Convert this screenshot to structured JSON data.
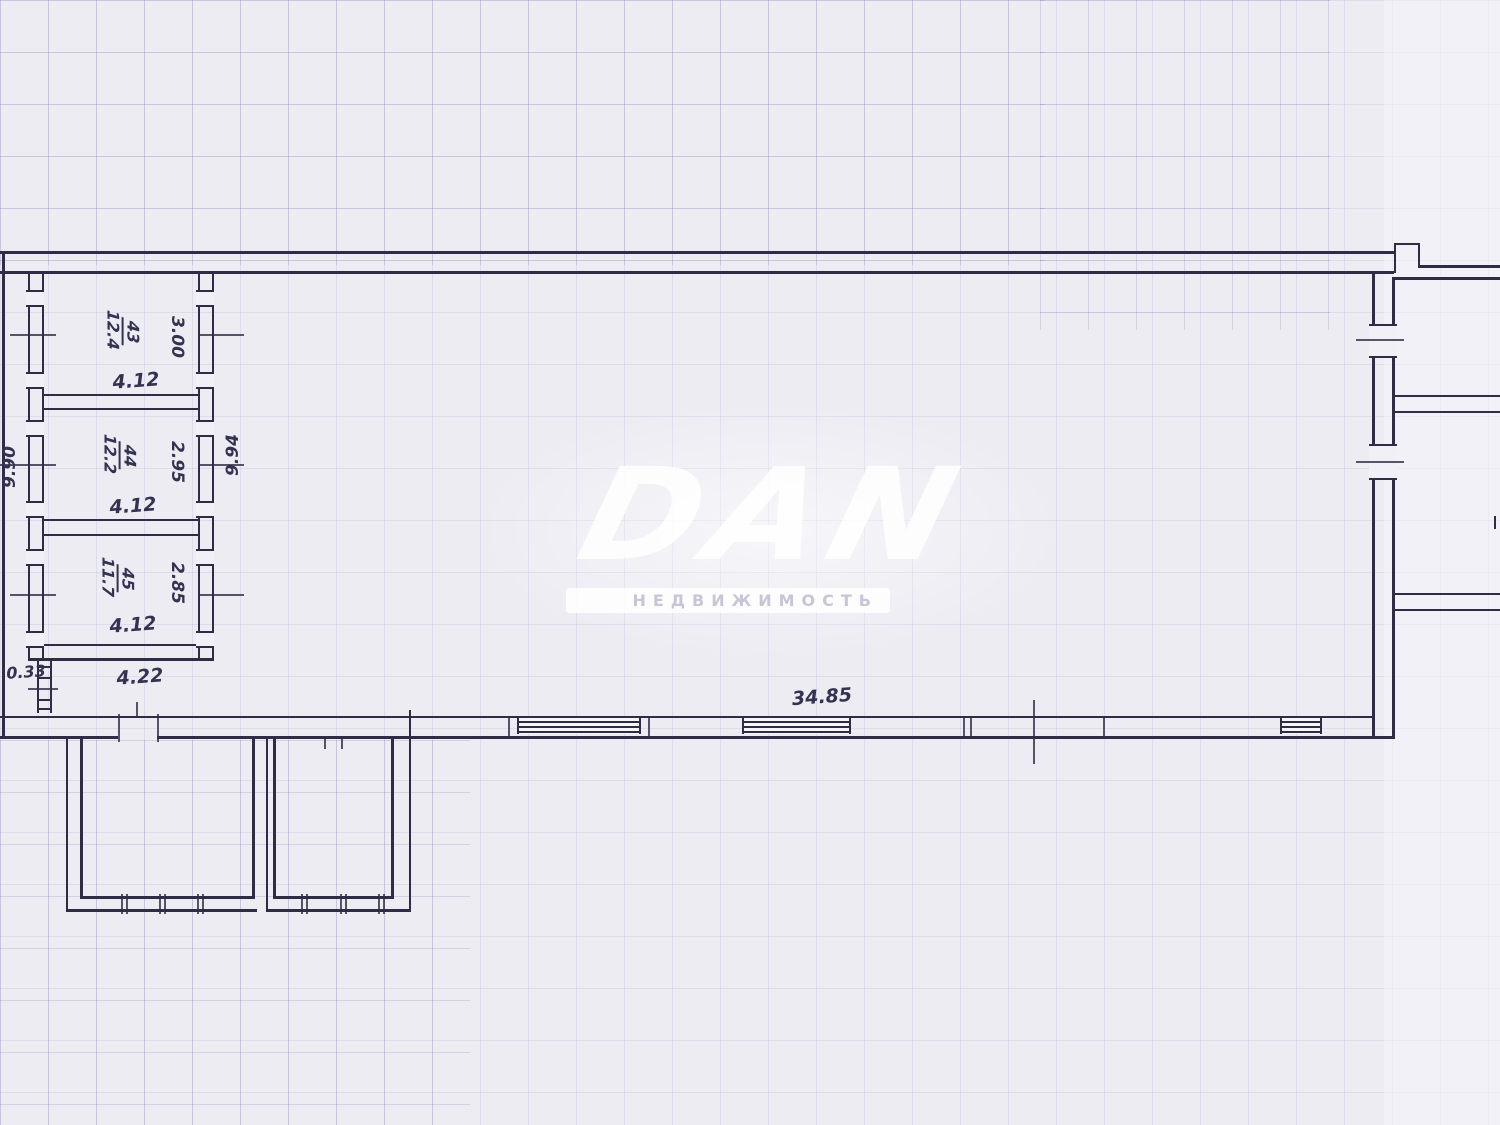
{
  "watermark": {
    "logo": "DAN",
    "subtitle": "НЕДВИЖИМОСТЬ"
  },
  "plan": {
    "rooms": [
      {
        "number": "43",
        "area": "12.4",
        "width": "4.12",
        "depth": "3.00"
      },
      {
        "number": "44",
        "area": "12.2",
        "width": "4.12",
        "depth": "2.95"
      },
      {
        "number": "45",
        "area": "11.7",
        "width": "4.12",
        "depth": "2.85"
      }
    ],
    "dimensions": {
      "left_height": "9.90",
      "inner_height": "9.94",
      "hall_width": "34.85",
      "porch_width": "4.22",
      "flue_width": "0.33"
    }
  }
}
